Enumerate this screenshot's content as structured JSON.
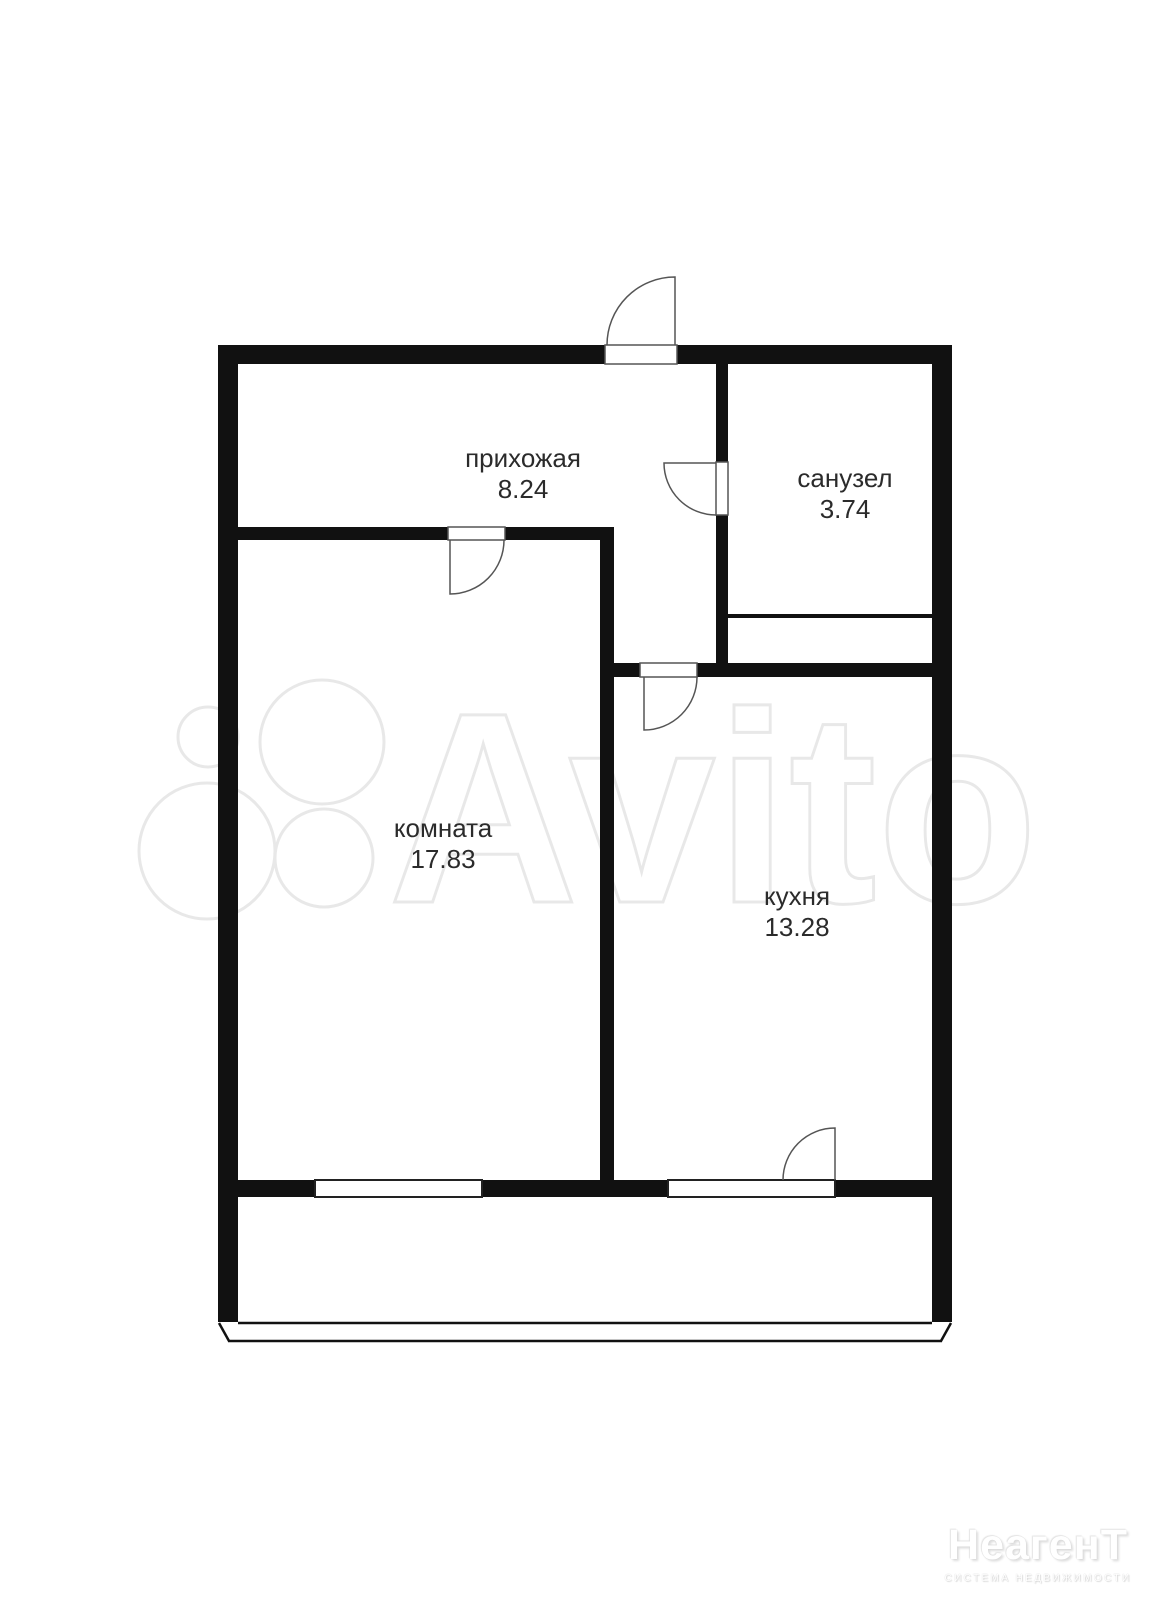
{
  "plan": {
    "rooms": [
      {
        "name": "прихожая",
        "area": "8.24"
      },
      {
        "name": "санузел",
        "area": "3.74"
      },
      {
        "name": "комната",
        "area": "17.83"
      },
      {
        "name": "кухня",
        "area": "13.28"
      }
    ]
  },
  "watermarks": {
    "avito_text": "Avito",
    "agency_name": "НеагенТ",
    "agency_tagline": "система недвижимости"
  },
  "colors": {
    "background": "#ffffff",
    "wall": "#111111",
    "door_line": "#555555",
    "window_stroke": "#222222",
    "label_text": "#2b2b2b",
    "watermark_gray": "#e8e8e8"
  }
}
